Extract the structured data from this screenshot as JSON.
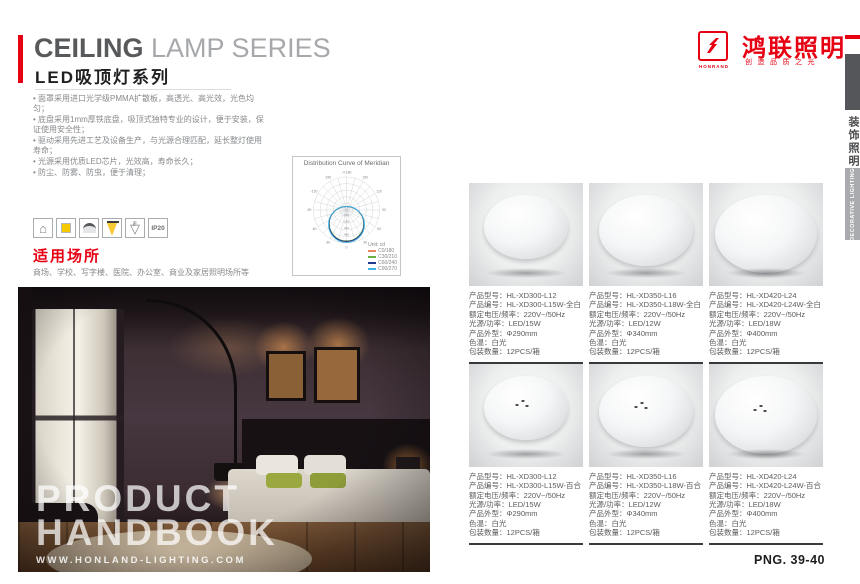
{
  "left": {
    "title_en_bold": "CEILING",
    "title_en_light": " LAMP SERIES",
    "title_cn": "LED吸顶灯系列",
    "features": [
      "面罩采用进口光学级PMMA扩散板，高透光、高光效，光色均匀；",
      "底盘采用1mm厚铁底盘，吸顶式独特专业的设计，便于安装，保证使用安全性；",
      "驱动采用先进工艺及设备生产，与光源合理匹配，延长整灯使用寿命；",
      "光源采用优质LED芯片，光效高，寿命长久；",
      "防尘、防雾、防虫，便于清理；"
    ],
    "usage_title": "适用场所",
    "usage_text": "商场、学校、写字楼、医院、办公室、商业及家居照明场所等",
    "photo_overlay": {
      "line1": "PRODUCT",
      "line2": "HANDBOOK",
      "website": "WWW.HONLAND-LIGHTING.COM"
    }
  },
  "icons": {
    "list": [
      "house-icon",
      "led-chip-icon",
      "ceiling-lamp-icon",
      "light-beam-icon",
      "f-mark-icon",
      "ip-rating-badge"
    ],
    "f_mark": "F",
    "ip_rating": "IP20"
  },
  "brand": {
    "logo_abbr": "HONRAND",
    "name_cn": "鸿联照明",
    "slogan_cn": "创造品质之光",
    "color": "#e60012"
  },
  "side_tab": {
    "category_cn": "装饰照明",
    "category_en": "DECORATIVE LIGHTING"
  },
  "page_number": "PNG. 39-40",
  "spec_labels": {
    "model": "产品型号",
    "code": "产品编号",
    "voltage": "额定电压/频率",
    "power": "光源/功率",
    "size": "产品外型",
    "cct": "色温",
    "packing": "包装数量"
  },
  "products": [
    {
      "model": "HL-XD300-L12",
      "code": "HL-XD300-L15W-全白",
      "voltage": "220V~/50Hz",
      "power": "LED/15W",
      "size": "Φ290mm",
      "cct": "白光",
      "packing": "12PCS/箱",
      "style": "全白"
    },
    {
      "model": "HL-XD350-L16",
      "code": "HL-XD350-L18W-全白",
      "voltage": "220V~/50Hz",
      "power": "LED/12W",
      "size": "Φ340mm",
      "cct": "白光",
      "packing": "12PCS/箱",
      "style": "全白"
    },
    {
      "model": "HL-XD420-L24",
      "code": "HL-XD420-L24W-全白",
      "voltage": "220V~/50Hz",
      "power": "LED/18W",
      "size": "Φ400mm",
      "cct": "白光",
      "packing": "12PCS/箱",
      "style": "全白"
    },
    {
      "model": "HL-XD300-L12",
      "code": "HL-XD300-L15W-百合",
      "voltage": "220V~/50Hz",
      "power": "LED/15W",
      "size": "Φ290mm",
      "cct": "白光",
      "packing": "12PCS/箱",
      "style": "百合"
    },
    {
      "model": "HL-XD350-L16",
      "code": "HL-XD350-L18W-百合",
      "voltage": "220V~/50Hz",
      "power": "LED/12W",
      "size": "Φ340mm",
      "cct": "白光",
      "packing": "12PCS/箱",
      "style": "百合"
    },
    {
      "model": "HL-XD420-L24",
      "code": "HL-XD420-L24W-百合",
      "voltage": "220V~/50Hz",
      "power": "LED/18W",
      "size": "Φ400mm",
      "cct": "白光",
      "packing": "12PCS/箱",
      "style": "百合"
    }
  ],
  "chart_data": {
    "type": "line",
    "subtype": "polar-intensity-distribution",
    "title": "Distribution Curve of Meridian",
    "unit_label": "Unit: cd",
    "grid": true,
    "legend_position": "bottom-right",
    "angle_labels": [
      {
        "angle": 0,
        "label": "0"
      },
      {
        "angle": 30,
        "label": "30"
      },
      {
        "angle": 60,
        "label": "60"
      },
      {
        "angle": 90,
        "label": "90"
      },
      {
        "angle": 120,
        "label": "120"
      },
      {
        "angle": 150,
        "label": "150"
      },
      {
        "angle": 180,
        "label": "-/+180"
      },
      {
        "angle": -30,
        "label": "-30"
      },
      {
        "angle": -60,
        "label": "-60"
      },
      {
        "angle": -90,
        "label": "-90"
      },
      {
        "angle": -120,
        "label": "-120"
      },
      {
        "angle": -150,
        "label": "-150"
      }
    ],
    "ring_values": [
      160,
      240,
      320,
      400,
      480
    ],
    "max_ring": 480,
    "series": [
      {
        "name": "C0/180",
        "color": "#e8875f",
        "peak_cd": 465
      },
      {
        "name": "C30/210",
        "color": "#6cb044",
        "peak_cd": 450
      },
      {
        "name": "C60/240",
        "color": "#243a8f",
        "peak_cd": 458
      },
      {
        "name": "C90/270",
        "color": "#3fb3e6",
        "peak_cd": 472
      }
    ]
  }
}
